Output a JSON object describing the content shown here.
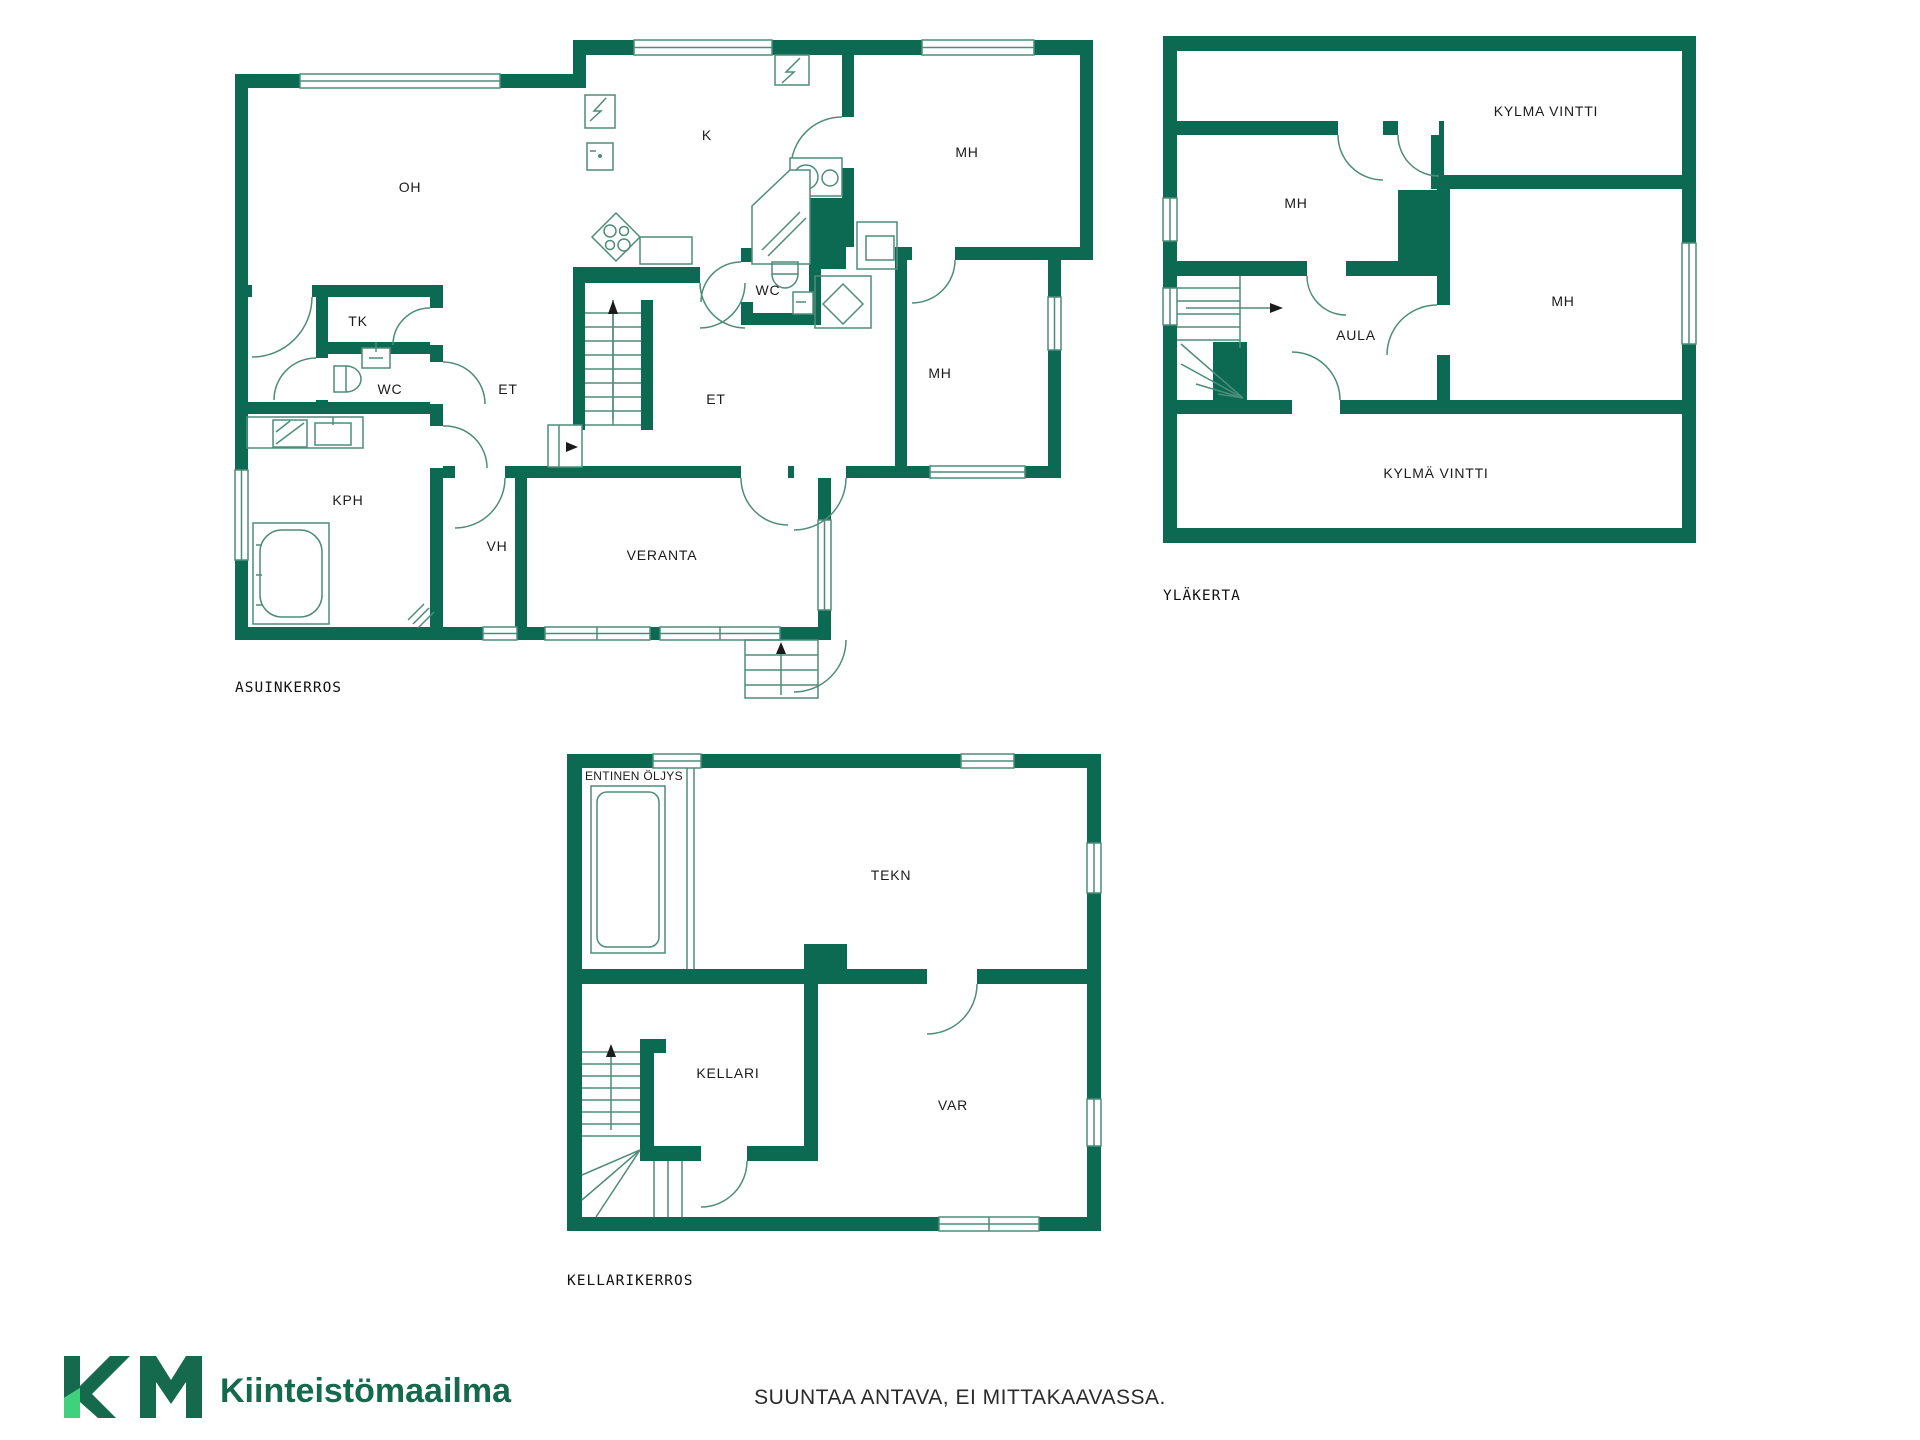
{
  "page": {
    "kind": "real-estate floor plan sheet",
    "background": "#ffffff"
  },
  "colors": {
    "wall_green": "#0d6a52",
    "line_teal": "#4e8c7a",
    "label_dark": "#1b1b1b",
    "logo_dark_green": "#156a4e",
    "logo_light_green": "#3fd17d",
    "disclaimer_text_color": "#2b2b2b"
  },
  "floors": [
    {
      "caption": "ASUINKERROS",
      "rooms": [
        {
          "label": "OH"
        },
        {
          "label": "K"
        },
        {
          "label": "MH"
        },
        {
          "label": "WC"
        },
        {
          "label": "MH"
        },
        {
          "label": "TK"
        },
        {
          "label": "WC"
        },
        {
          "label": "ET"
        },
        {
          "label": "ET"
        },
        {
          "label": "KPH"
        },
        {
          "label": "VH"
        },
        {
          "label": "VERANTA"
        }
      ]
    },
    {
      "caption": "YLÄKERTA",
      "rooms": [
        {
          "label": "KYLMA VINTTI"
        },
        {
          "label": "MH"
        },
        {
          "label": "MH"
        },
        {
          "label": "AULA"
        },
        {
          "label": "KYLMÄ VINTTI"
        }
      ]
    },
    {
      "caption": "KELLARIKERROS",
      "rooms": [
        {
          "label": "ENTINEN ÖLJYS"
        },
        {
          "label": "TEKN"
        },
        {
          "label": "KELLARI"
        },
        {
          "label": "VAR"
        }
      ]
    }
  ],
  "footer": {
    "brand": "Kiinteistömaailma",
    "logo_mark": "KM",
    "disclaimer": "SUUNTAA ANTAVA, EI MITTAKAAVASSA."
  }
}
